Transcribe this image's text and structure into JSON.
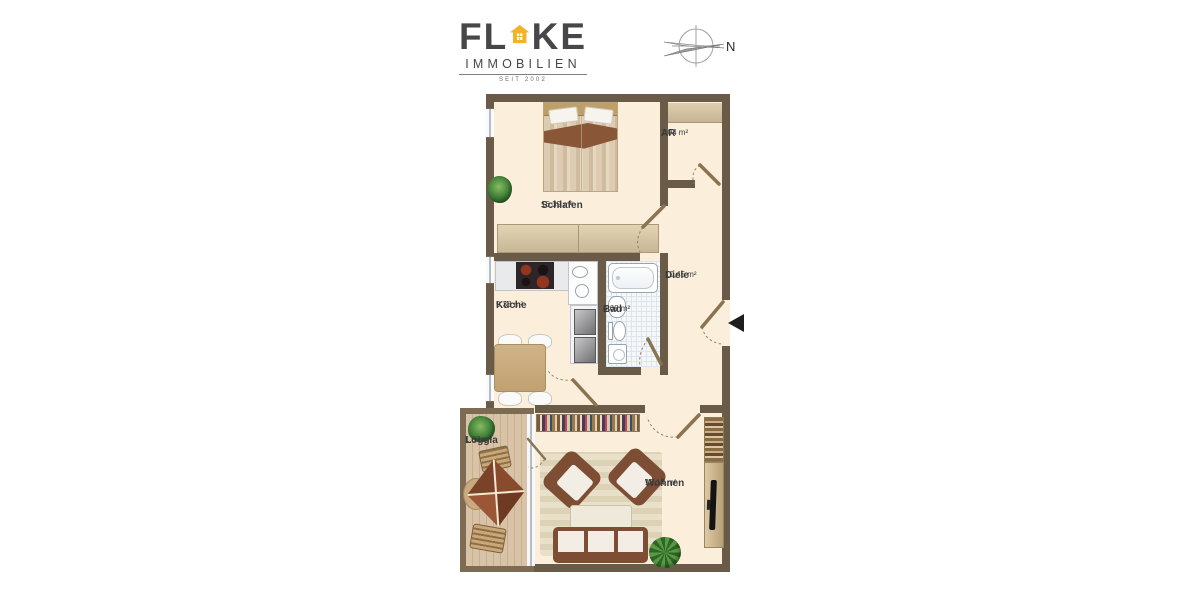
{
  "brand": {
    "name_left": "FL",
    "name_right": "KE",
    "subtitle": "IMMOBILIEN",
    "since": "SEIT 2002"
  },
  "compass": {
    "north_label": "N"
  },
  "plan": {
    "rooms": [
      {
        "name": "Schlafen",
        "area": "16,39 m²"
      },
      {
        "name": "AR",
        "area": "2,04 m²"
      },
      {
        "name": "Diele",
        "area": "10,45 m²"
      },
      {
        "name": "Küche",
        "area": "9,38 m²"
      },
      {
        "name": "Bad",
        "area": "4,68 m²"
      },
      {
        "name": "Loggia",
        "area": "1,69 m²"
      },
      {
        "name": "Wohnen",
        "area": "19,14 m²"
      }
    ]
  },
  "colors": {
    "wall": "#6a5b49",
    "wall_light": "#7d6b54",
    "floor": "#fbeeda",
    "loggia_floor": "#d9c3a7",
    "wood": "#d6c6a5",
    "wood_dark": "#bf9f68",
    "upholstery": "#7d4e33",
    "cushion": "#f2eee5",
    "brand_gray": "#47474a",
    "brand_yellow": "#f0b42a",
    "tile": "#f5f7f9",
    "counter": "#e9eaec"
  }
}
